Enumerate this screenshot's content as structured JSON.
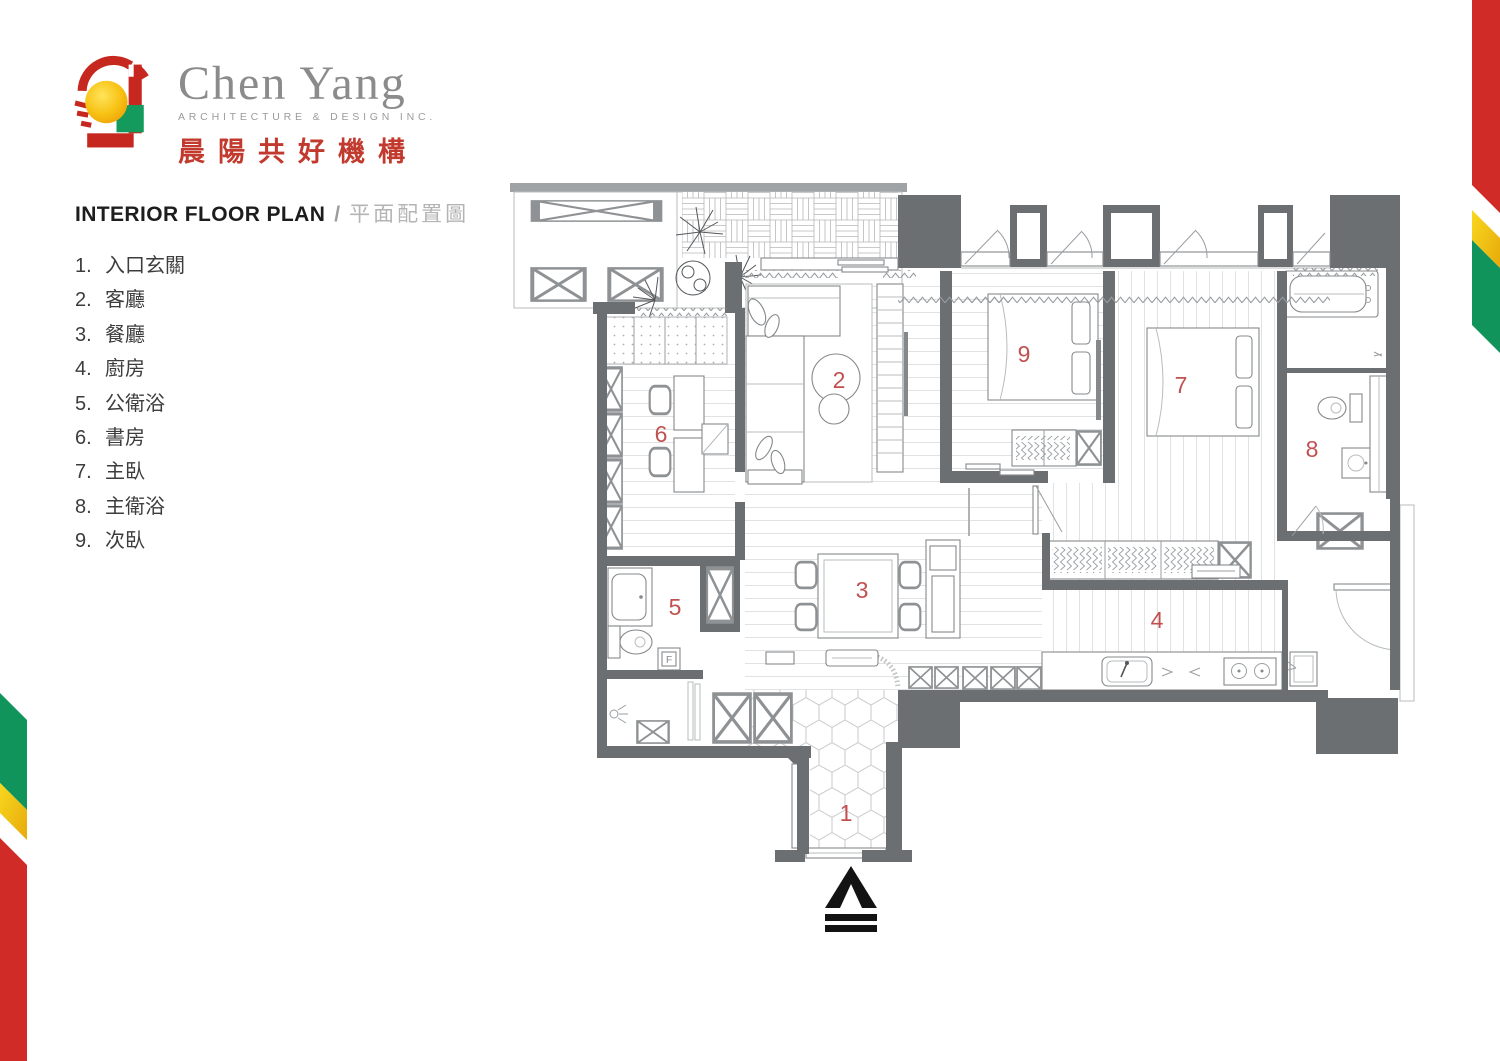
{
  "brand": {
    "name_en": "Chen Yang",
    "tagline_en": "ARCHITECTURE & DESIGN INC.",
    "name_zh": "晨陽共好機構",
    "colors": {
      "red": "#c6271e",
      "yellow": "#f5b80c",
      "green": "#159a5e",
      "gray": "#8b8b8b"
    }
  },
  "heading": {
    "en": "INTERIOR FLOOR PLAN",
    "sep": "/",
    "zh": "平面配置圖"
  },
  "legend": [
    {
      "num": "1.",
      "name": "入口玄關"
    },
    {
      "num": "2.",
      "name": "客廳"
    },
    {
      "num": "3.",
      "name": "餐廳"
    },
    {
      "num": "4.",
      "name": "廚房"
    },
    {
      "num": "5.",
      "name": "公衛浴"
    },
    {
      "num": "6.",
      "name": "書房"
    },
    {
      "num": "7.",
      "name": "主臥"
    },
    {
      "num": "8.",
      "name": "主衛浴"
    },
    {
      "num": "9.",
      "name": "次臥"
    }
  ],
  "plan": {
    "labels": {
      "l1": "1",
      "l2": "2",
      "l3": "3",
      "l4": "4",
      "l5": "5",
      "l6": "6",
      "l7": "7",
      "l8": "8",
      "l9": "9"
    },
    "label_color": "#c15150",
    "wall_color": "#6c6f71",
    "drain_label": "F",
    "icons": {
      "north": "north-arrow",
      "plants": "potted-plants"
    }
  },
  "ribbons": {
    "red": "#d02b26",
    "yellow": "#f2c217",
    "green": "#11945c"
  }
}
